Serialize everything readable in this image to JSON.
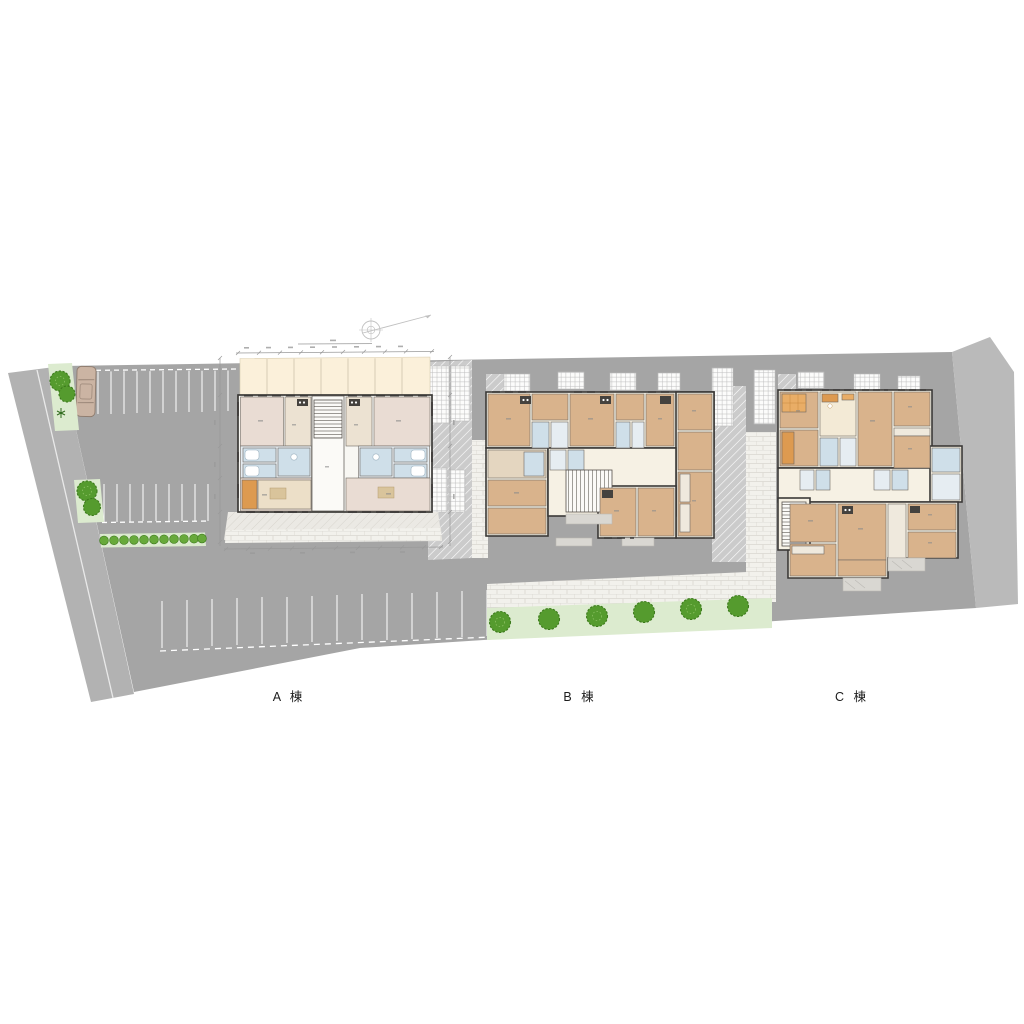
{
  "plan": {
    "title": "residential site plan",
    "buildings": {
      "a": {
        "label": "A 棟"
      },
      "b": {
        "label": "B 棟"
      },
      "c": {
        "label": "C 棟"
      }
    },
    "colors": {
      "lot": "#a5a5a5",
      "road": "#b2b2b2",
      "driveway": "#bababa",
      "green_strip": "#dcebcf",
      "tree": "#559b2e",
      "tree_dark": "#3c7a1c",
      "shrub": "#67a93a",
      "cream": "#f6f1e4",
      "tan": "#d9b38c",
      "tan_light": "#e4d6c0",
      "room_a": "#e9dcd3",
      "room_a_light": "#ece2d2",
      "bath_blue": "#cfdfe9",
      "bath_light": "#e6edf2",
      "balcony": "#fbf0da",
      "core": "#f8f7f3",
      "orange": "#dd9a50",
      "orange_light": "#e9ad66",
      "kitchen_dark": "#45423e",
      "porch": "#d9d7d2",
      "car_body": "#cbb4a3",
      "car_line": "#8f7c6e",
      "wall": "#3b3937",
      "dim": "#999999",
      "compass": "#c0c0c0",
      "label": "#1d1d1d"
    }
  }
}
